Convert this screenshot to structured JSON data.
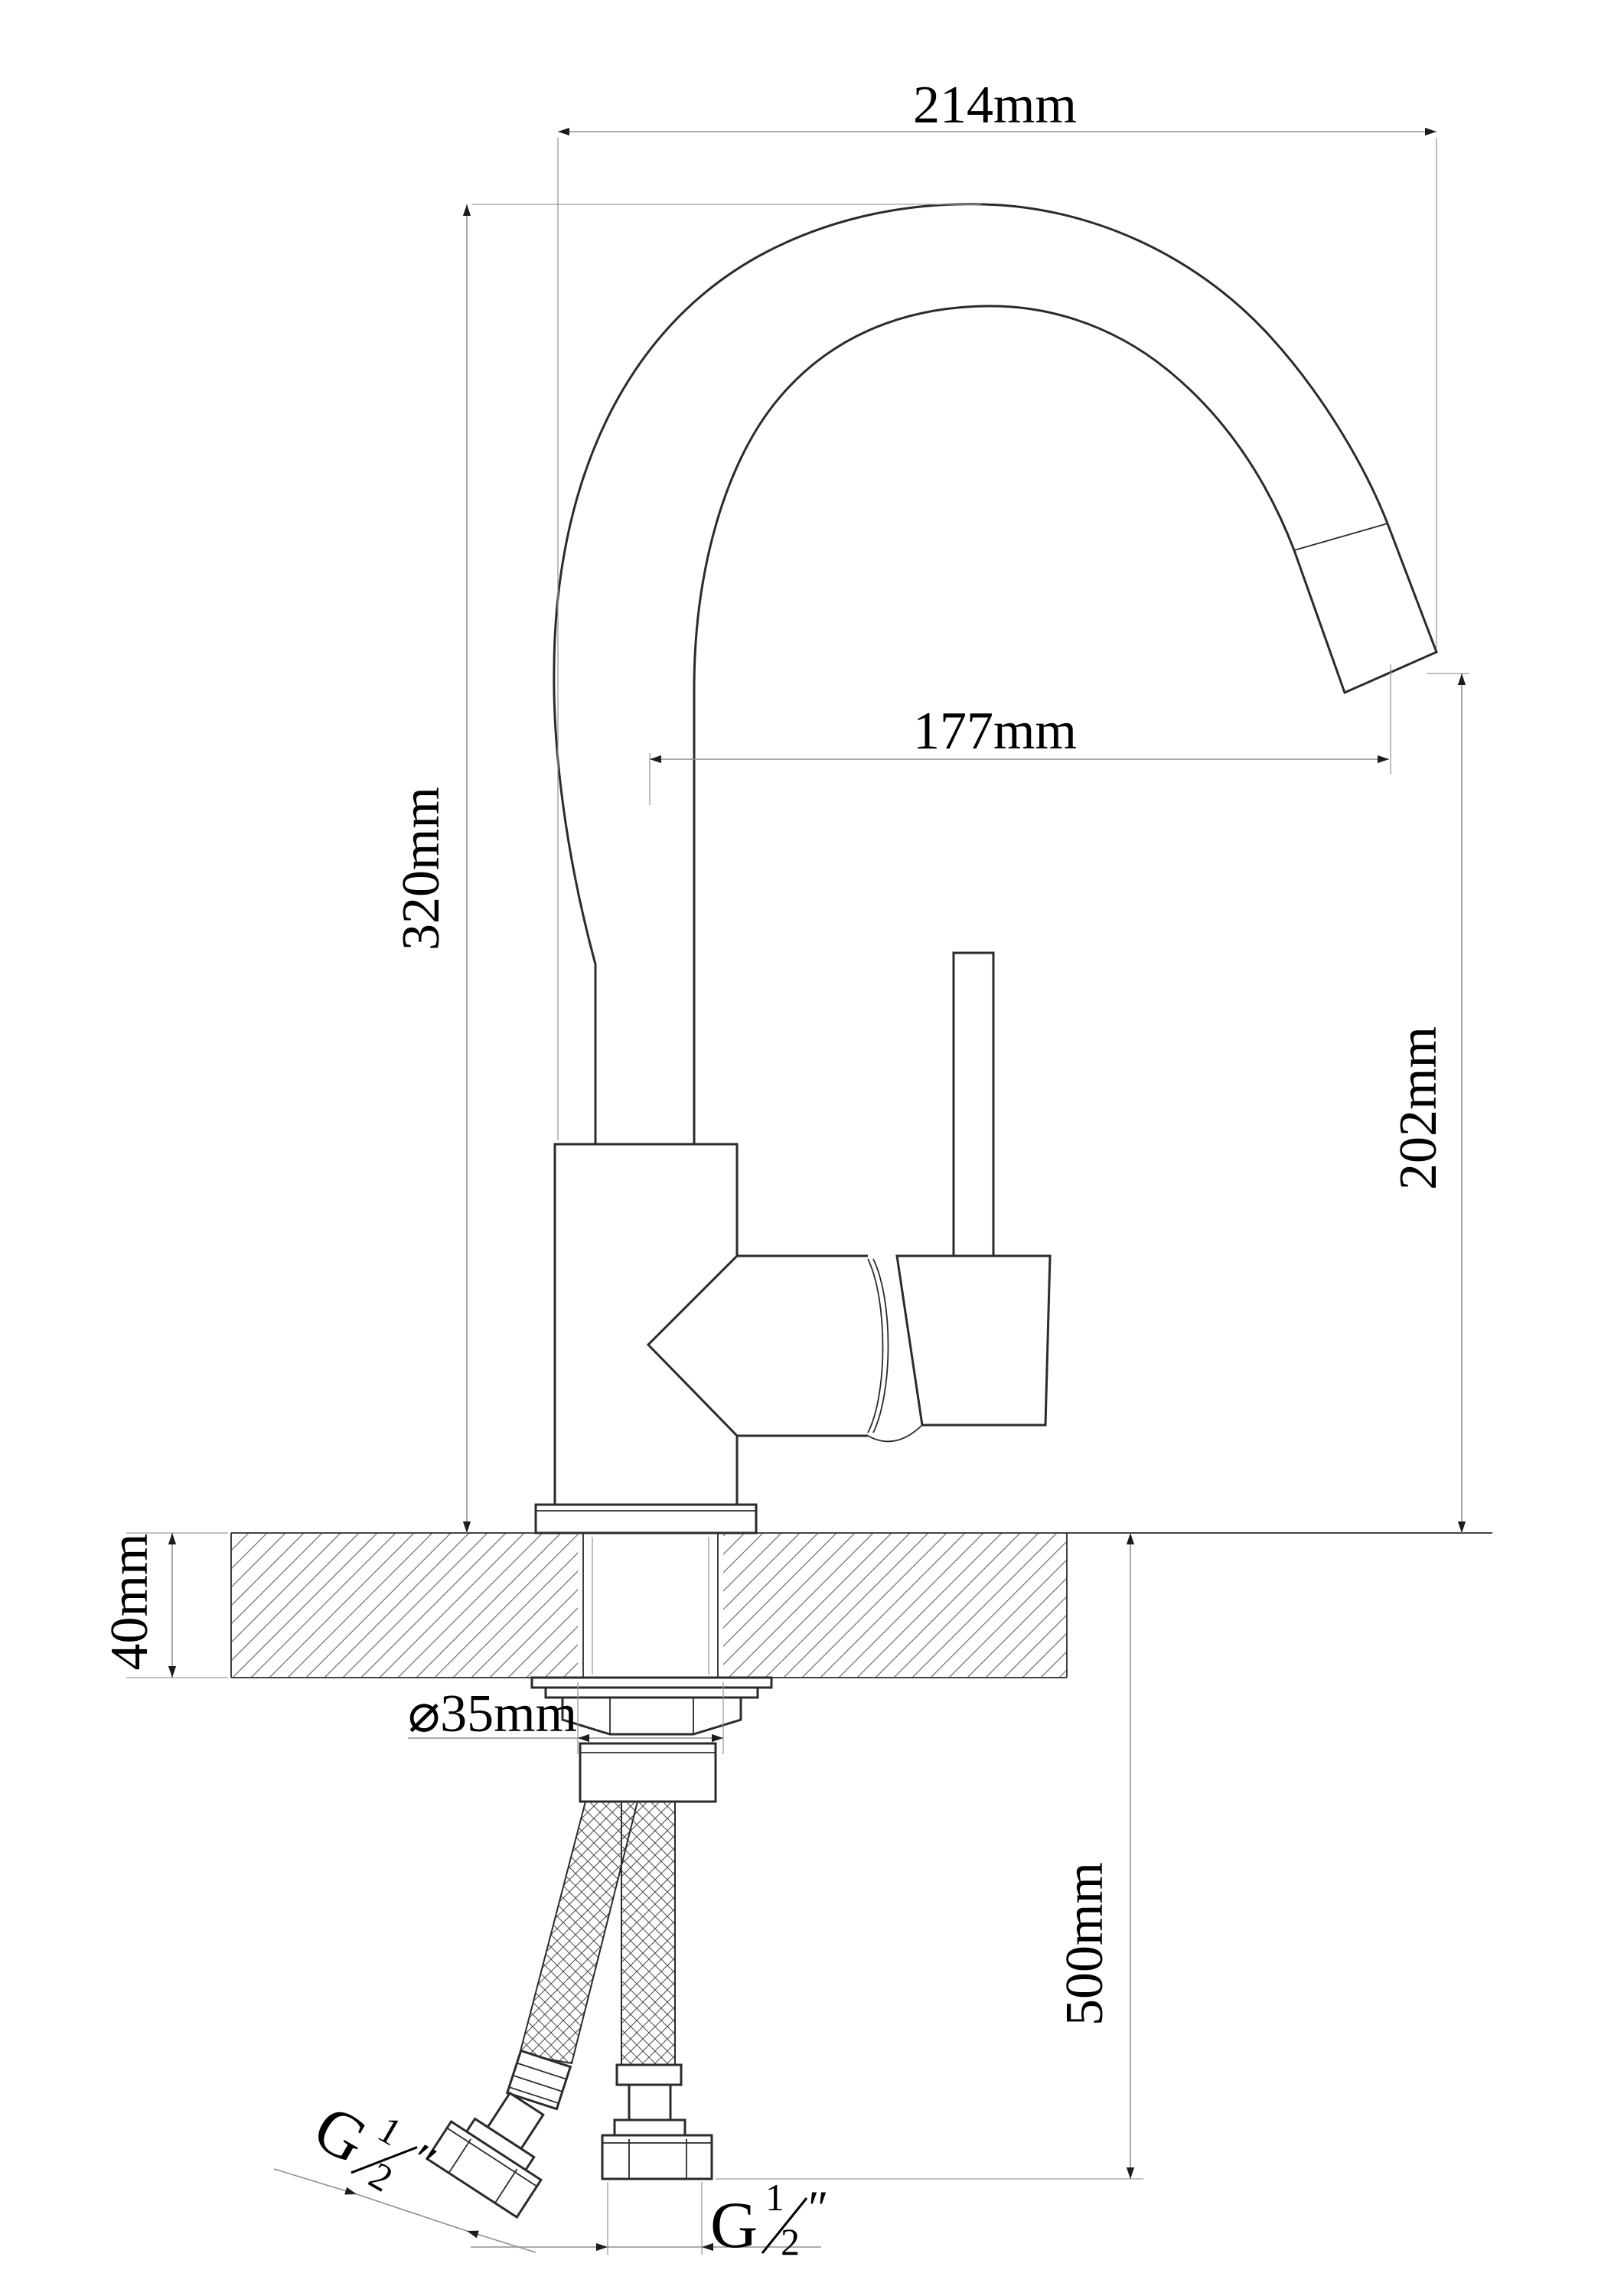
{
  "labels": {
    "spout_width": "214mm",
    "spout_reach": "177mm",
    "spout_height": "320mm",
    "outlet_clearance": "202mm",
    "deck_thickness": "40mm",
    "hole_diameter": "⌀35mm",
    "hose_length": "500mm",
    "thread_g": "G",
    "thread_num": "1",
    "thread_den": "2",
    "thread_inch": "″"
  }
}
